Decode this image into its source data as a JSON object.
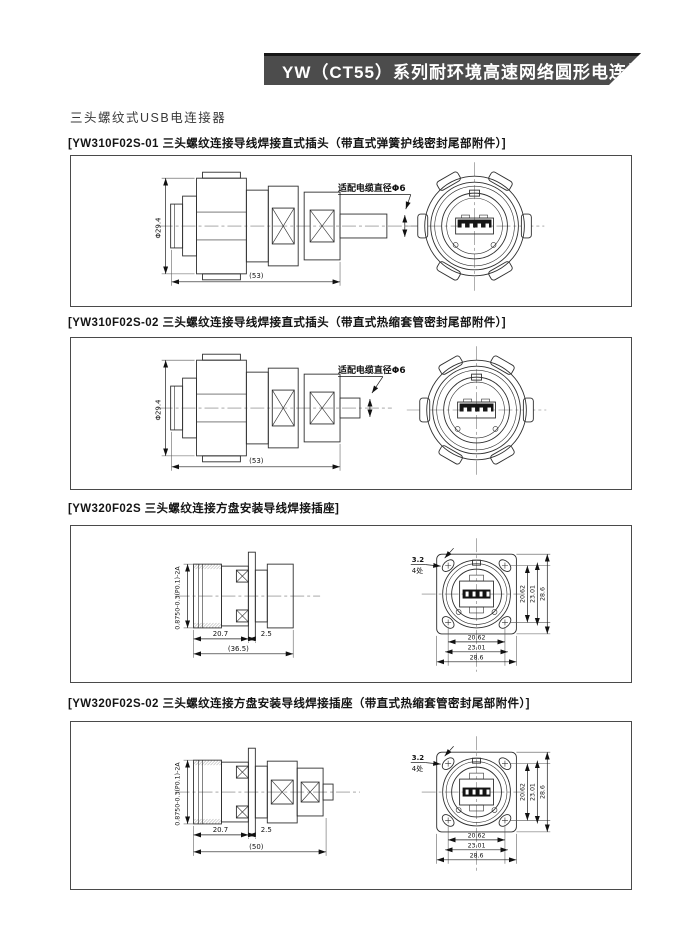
{
  "banner": {
    "title": "YW（CT55）系列耐环境高速网络圆形电连接器"
  },
  "page": {
    "subtitle": "三头螺纹式USB电连接器"
  },
  "sections": [
    {
      "label": "[YW310F02S-01 三头螺纹连接导线焊接直式插头（带直式弹簧护线密封尾部附件）]",
      "dims": {
        "diameter": "Φ29.4",
        "length": "(53)",
        "cable_note": "适配电缆直径Φ6"
      }
    },
    {
      "label": "[YW310F02S-02 三头螺纹连接导线焊接直式插头（带直式热缩套管密封尾部附件）]",
      "dims": {
        "diameter": "Φ29.4",
        "length": "(53)",
        "cable_note": "适配电缆直径Φ6"
      }
    },
    {
      "label": "[YW320F02S 三头螺纹连接方盘安装导线焊接插座]",
      "dims": {
        "thread": "0.8750-0.3(P0.1)-2A",
        "front_len": "20.7",
        "flange_thk": "2.5",
        "overall": "(36.5)",
        "hole": "3.2",
        "hole_places": "4处",
        "sq_inner": "20.62",
        "sq_mid": "23.01",
        "sq_outer": "28.6"
      }
    },
    {
      "label": "[YW320F02S-02 三头螺纹连接方盘安装导线焊接插座（带直式热缩套管密封尾部附件）]",
      "dims": {
        "thread": "0.8750-0.3(P0.1)-2A",
        "front_len": "20.7",
        "flange_thk": "2.5",
        "overall": "(50)",
        "hole": "3.2",
        "hole_places": "4处",
        "sq_inner": "20.62",
        "sq_mid": "23.01",
        "sq_outer": "28.6"
      }
    }
  ]
}
